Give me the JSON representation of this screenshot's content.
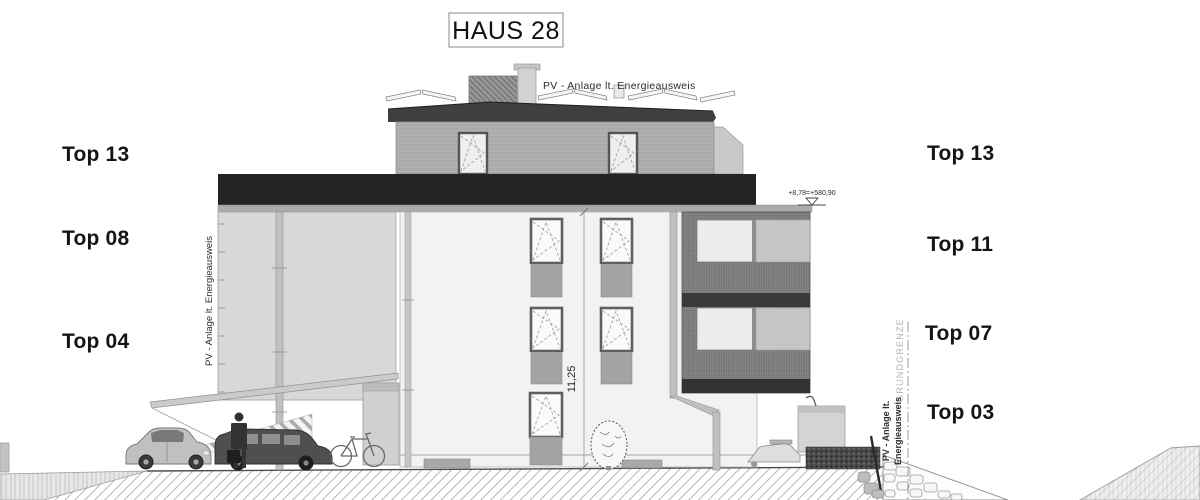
{
  "title": {
    "text": "HAUS 28"
  },
  "annotations": {
    "pv_top": "PV - Anlage lt. Energieausweis",
    "pv_left_vertical": "PV - Anlage lt. Energieausweis",
    "pv_right_line1": "PV - Anlage lt.",
    "pv_right_line2": "Energieausweis",
    "grundgrenze": "GRUNDGRENZE",
    "height_dimension": "11,25",
    "level_mark": "+8,78=+580,90"
  },
  "labels_left": [
    "Top 13",
    "Top 08",
    "Top 04"
  ],
  "labels_right": [
    "Top 13",
    "Top 11",
    "Top 07",
    "Top 03"
  ],
  "colors": {
    "ink": "#151515",
    "attic_band": "#242424",
    "roof_fascia": "#3f3f3f",
    "penthouse_wall": "#b2b2b2",
    "wing_wall": "#d8d8d8",
    "facade": "#f2f2f2",
    "balcony_block": "#7d7d7d",
    "spandrel": "#a3a3a3",
    "muted_text": "#b3b3b3"
  }
}
